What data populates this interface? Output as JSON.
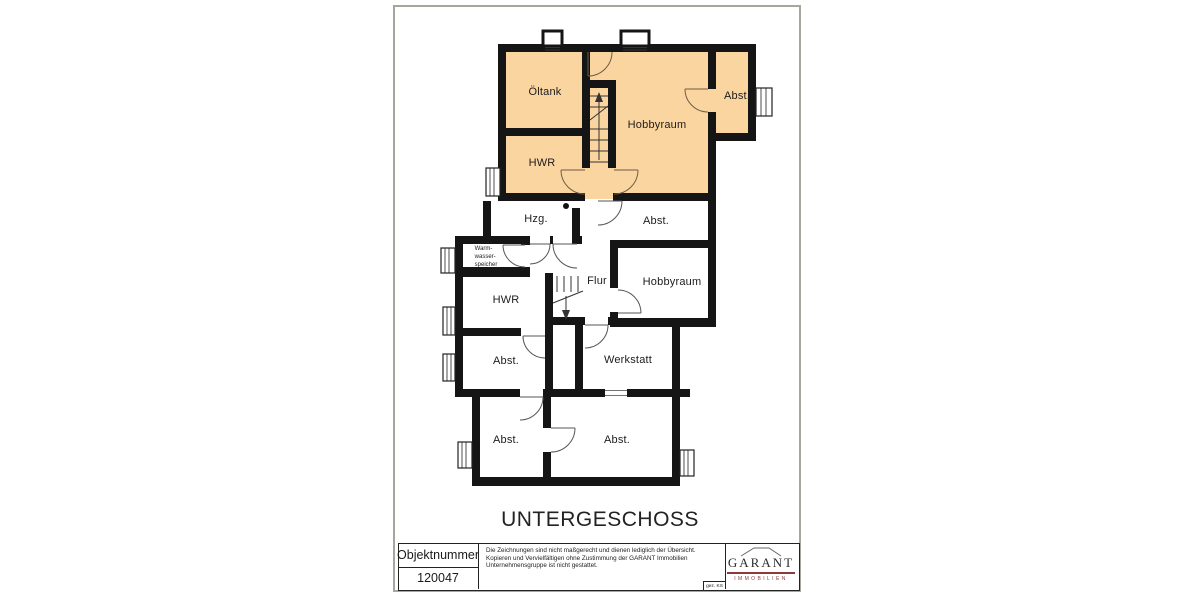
{
  "sheet": {
    "title": "UNTERGESCHOSS"
  },
  "rooms": [
    {
      "id": "oeltank",
      "label": "Öltank"
    },
    {
      "id": "hobbyraum-upper",
      "label": "Hobbyraum"
    },
    {
      "id": "abst-upper",
      "label": "Abst."
    },
    {
      "id": "hwr-upper",
      "label": "HWR"
    },
    {
      "id": "hzg",
      "label": "Hzg."
    },
    {
      "id": "abst-middle",
      "label": "Abst."
    },
    {
      "id": "warmwasserspeicher",
      "lines": [
        "Warm-",
        "wasser-",
        "speicher"
      ]
    },
    {
      "id": "hwr-lower",
      "label": "HWR"
    },
    {
      "id": "flur",
      "label": "Flur"
    },
    {
      "id": "hobbyraum-lower",
      "label": "Hobbyraum"
    },
    {
      "id": "abst-mid-left",
      "label": "Abst."
    },
    {
      "id": "werkstatt",
      "label": "Werkstatt"
    },
    {
      "id": "abst-bottom-left",
      "label": "Abst."
    },
    {
      "id": "abst-bottom-right",
      "label": "Abst."
    }
  ],
  "title_block": {
    "object_number_label": "Objektnummer",
    "object_number_value": "120047",
    "disclaimer": [
      "Die Zeichnungen sind nicht maßgerecht und dienen lediglich der Übersicht.",
      "Kopieren und Vervielfältigen ohne Zustimmung der GARANT Immobilien",
      "Unternehmensgruppe ist nicht gestattet."
    ],
    "signature": "gez. KS",
    "logo_name": "GARANT",
    "logo_subtitle": "IMMOBILIEN"
  },
  "colors": {
    "highlight": "#FBD5A0",
    "wall": "#151515",
    "accent": "#8B3A3A"
  }
}
